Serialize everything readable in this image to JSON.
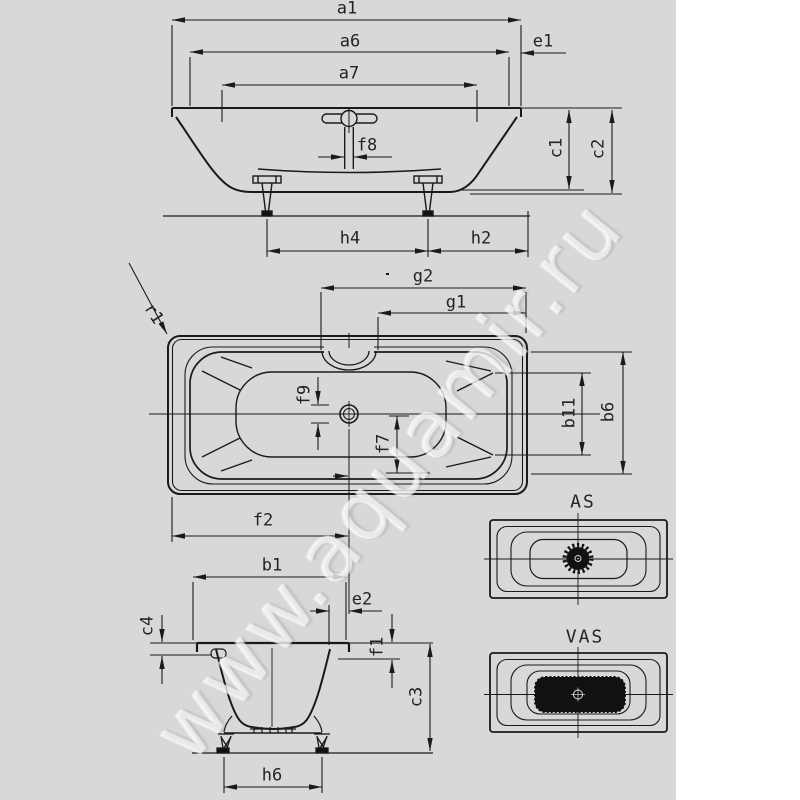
{
  "colors": {
    "background": "#d8d8d8",
    "panel": "#ffffff",
    "line": "#1a1a1a",
    "text": "#232323",
    "dark": "#111111"
  },
  "watermark": {
    "text": "www.aquamir.ru"
  },
  "variant_views": {
    "air_system": "AS",
    "water_air_system": "VAS"
  },
  "dimension_labels": {
    "side_view": {
      "a1": "a1",
      "a6": "a6",
      "a7": "a7",
      "e1": "e1",
      "c1": "c1",
      "c2": "c2",
      "f8": "f8",
      "h4": "h4",
      "h2": "h2"
    },
    "plan_view": {
      "g2": "g2",
      "g1": "g1",
      "r1": "r1",
      "f9": "f9",
      "f7": "f7",
      "b11": "b11",
      "b6": "b6",
      "f2": "f2"
    },
    "end_view": {
      "b1": "b1",
      "e2": "e2",
      "c4": "c4",
      "f1": "f1",
      "c3": "c3",
      "h6": "h6"
    }
  }
}
